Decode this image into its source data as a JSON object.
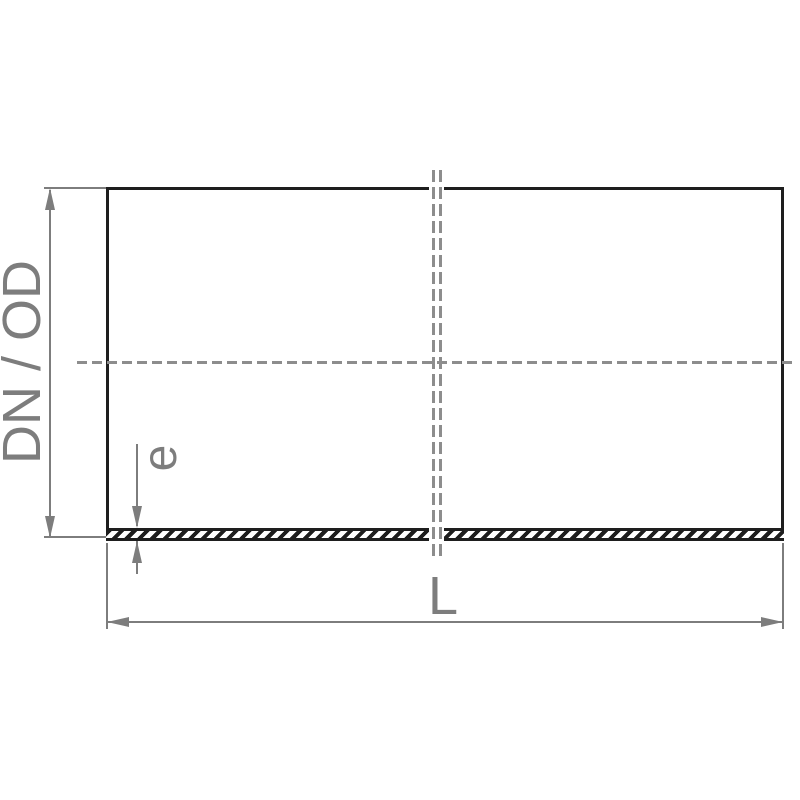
{
  "diagram": {
    "type": "technical-drawing-pipe-section",
    "labels": {
      "diameter": "DN / OD",
      "wall_thickness": "e",
      "length": "L"
    },
    "colors": {
      "outline": "#1e1e1e",
      "dimension": "#7d7d7d",
      "centerline": "#8d8d8d",
      "background": "#ffffff"
    }
  }
}
